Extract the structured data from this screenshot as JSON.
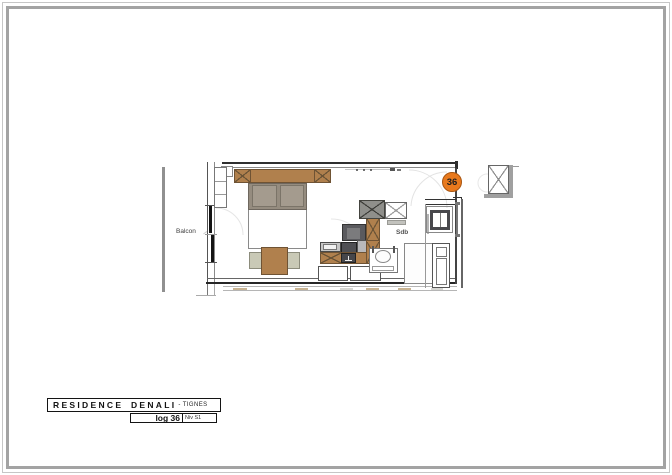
{
  "document": {
    "type": "apartment floor plan sheet",
    "labels": {
      "balcony": "Balcon",
      "bathroom": "Sdb"
    },
    "unit_badge": {
      "number": "36",
      "color": "#e8791d"
    },
    "title_block": {
      "residence": "RESIDENCE DENALI",
      "location": "- TIGNES",
      "unit": "log 36",
      "level": "Niv S1"
    },
    "colors": {
      "wood_furniture": "#b0804d",
      "bed_upholstery": "#9b9186",
      "chair": "#c9c9b6",
      "appliance_dark": "#515155",
      "counter_silver": "#c6c6c6",
      "wall_line": "#2f2f2f",
      "railing_gray": "#909090",
      "page_border": "#a3a3a3",
      "swing_arc": "#e3e3e3"
    }
  }
}
